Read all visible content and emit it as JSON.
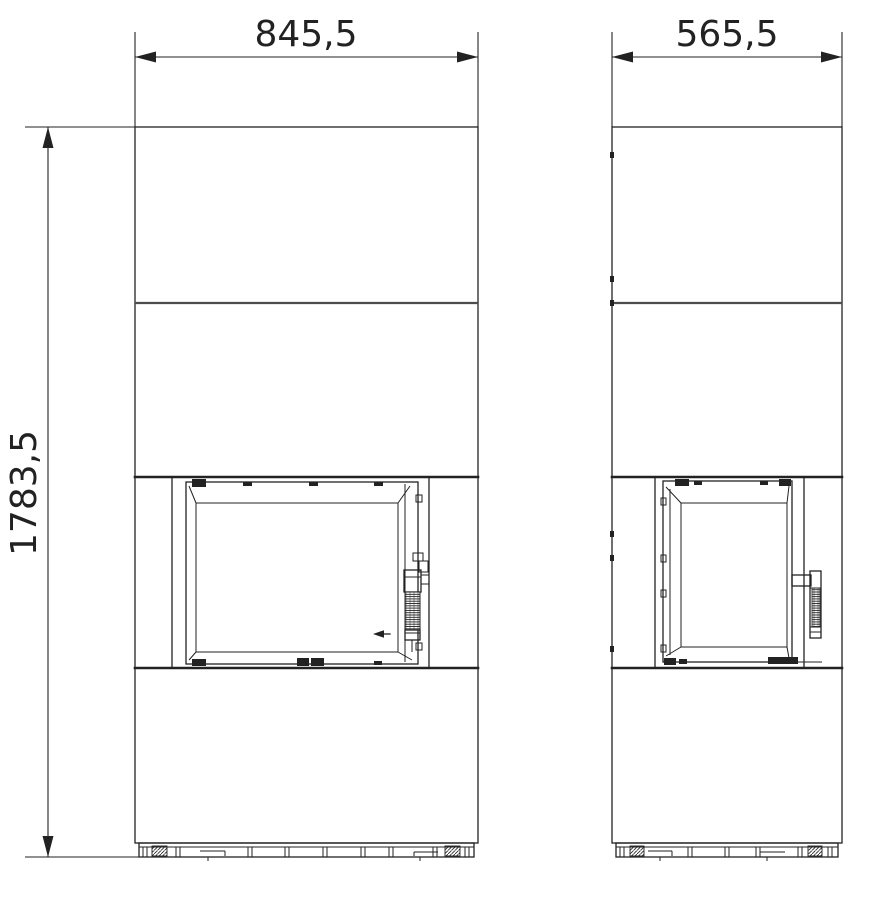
{
  "drawing": {
    "kind": "fireplace elevation technical drawing",
    "views": [
      {
        "name": "front elevation"
      },
      {
        "name": "side elevation"
      }
    ]
  },
  "dimensions": {
    "front_width": {
      "label": "845,5"
    },
    "side_width": {
      "label": "565,5"
    },
    "overall_height": {
      "label": "1783,5"
    }
  },
  "icons": {
    "dimension_arrow": "filled-triangle",
    "door_airflow_arrow": "left-arrow"
  },
  "colors": {
    "background": "#ffffff",
    "line": "#222222",
    "joint": "#4d4d4d"
  }
}
